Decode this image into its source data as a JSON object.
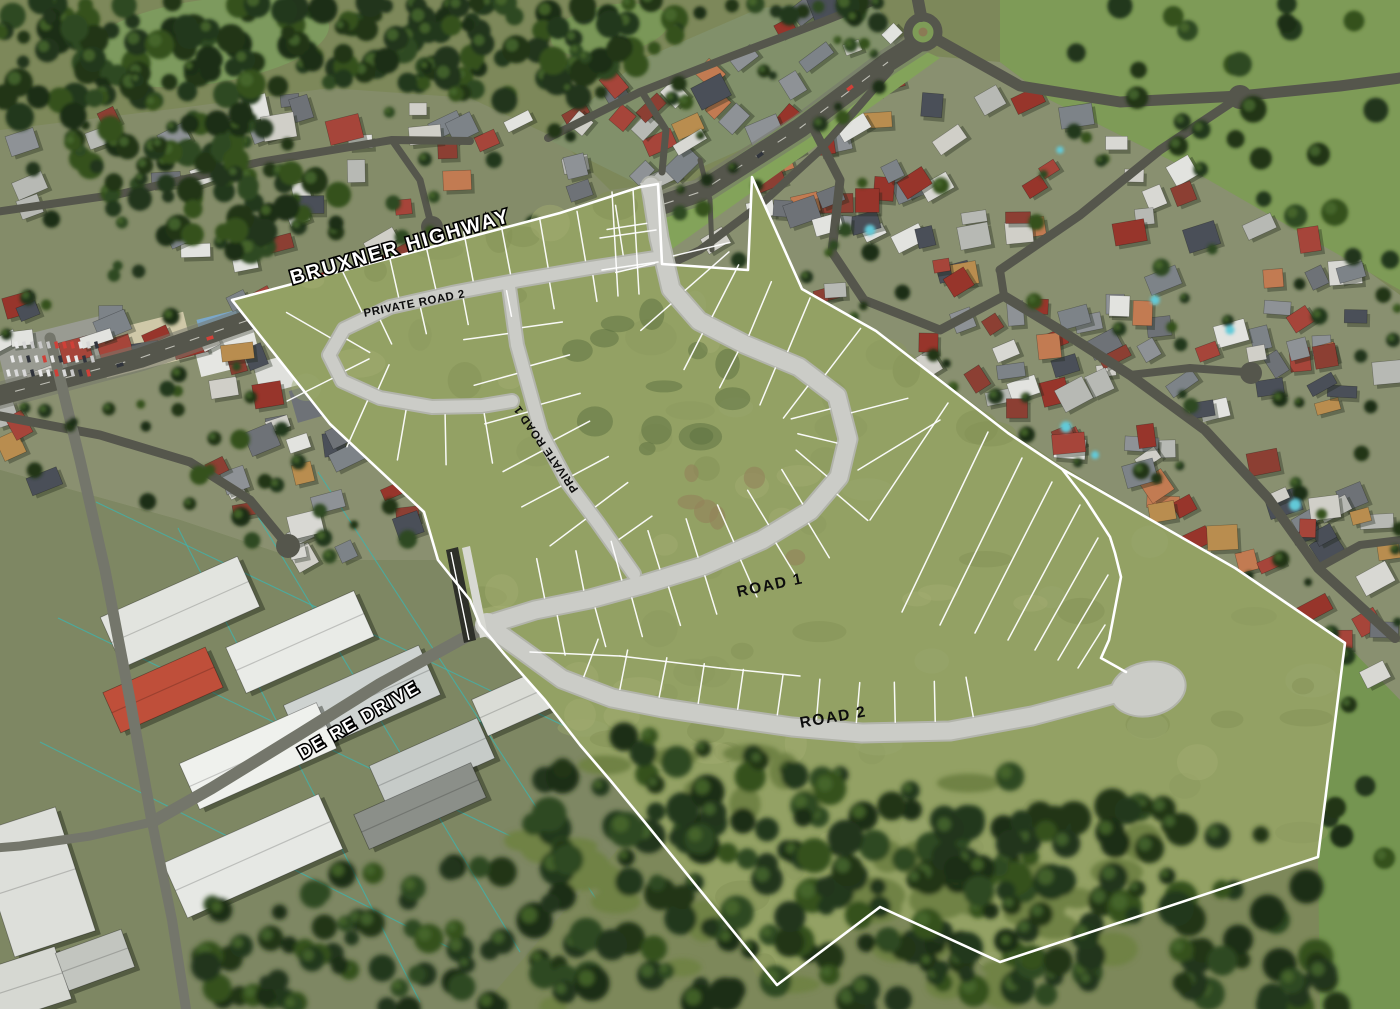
{
  "map": {
    "description": "Oblique aerial photograph with proposed subdivision masterplan overlay",
    "road_labels": [
      {
        "id": "bruxner-highway",
        "text": "BRUXNER HIGHWAY"
      },
      {
        "id": "private-road-2",
        "text": "PRIVATE ROAD 2"
      },
      {
        "id": "private-road-1",
        "text": "PRIVATE ROAD 1"
      },
      {
        "id": "road-1",
        "text": "ROAD 1"
      },
      {
        "id": "road-2",
        "text": "ROAD 2"
      },
      {
        "id": "de-re-drive",
        "text": "DE RE DRIVE"
      }
    ],
    "colors": {
      "site_grass": "#93a164",
      "proposed_road": "#cbccc7",
      "lot_line": "#ffffff",
      "boundary_line": "#ffffff",
      "existing_road": "#55564c",
      "bushland": "#22351a",
      "field": "#7e9b57",
      "cadastral": "#3fb3ac",
      "label_light": "#ffffff",
      "label_dark": "#0d0d0d"
    }
  }
}
